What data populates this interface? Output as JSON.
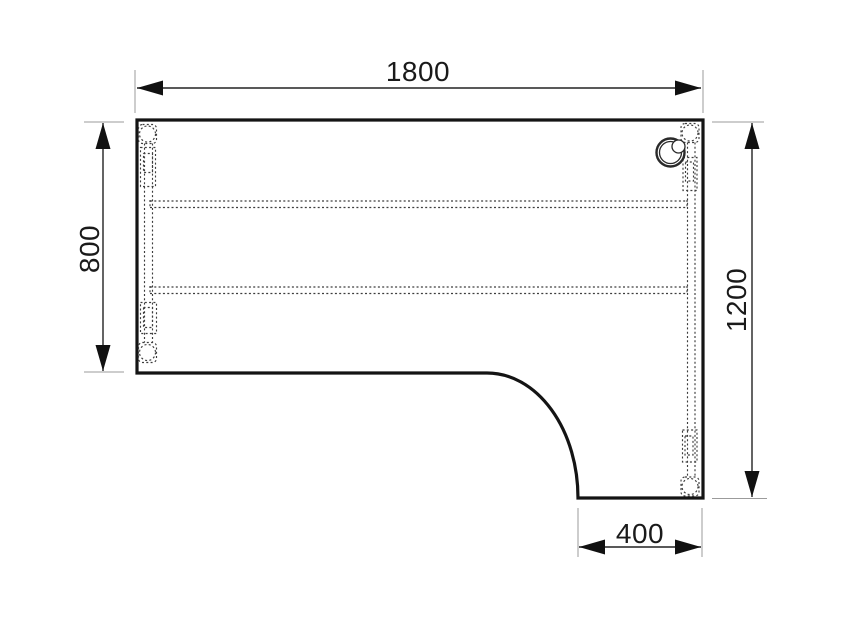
{
  "colors": {
    "ink": "#1a1a1a",
    "outline": "#141414",
    "hidden_line": "#3d3d3d",
    "extension_line": "#9b9b9b",
    "background": "#ffffff"
  },
  "drawing": {
    "subject": "corner-desk-top-view",
    "dimensions": {
      "top": {
        "value": "1800"
      },
      "left": {
        "value": "800"
      },
      "right": {
        "value": "1200"
      },
      "bottom": {
        "value": "400"
      }
    }
  }
}
